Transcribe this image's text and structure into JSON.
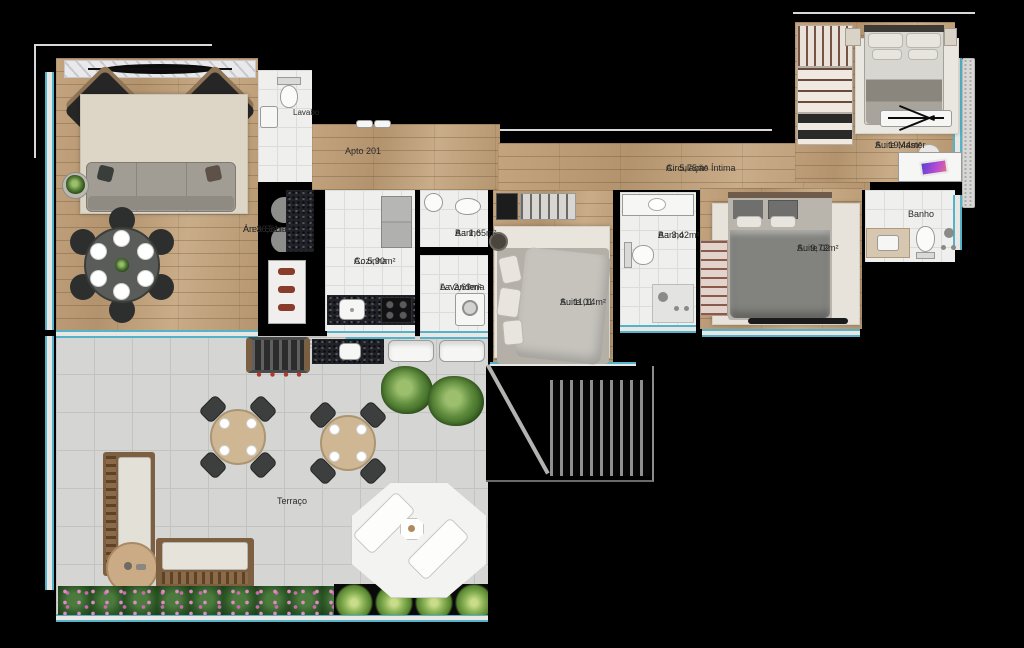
{
  "plan": {
    "unit_label": "Apto 201",
    "rooms": {
      "lavabo": {
        "name": "Lavabo",
        "area": ""
      },
      "area_social": {
        "name": "Área Social",
        "area": "A.: 36,51m²"
      },
      "cozinha": {
        "name": "Cozinha",
        "area": "A.: 5,90m²"
      },
      "banho_social": {
        "name": "Banho",
        "area": "A.: 1,65m²"
      },
      "lavanderia": {
        "name": "Lavanderia",
        "area": "A.: 2,69m²"
      },
      "circulacao": {
        "name": "Circulação Íntima",
        "area": "A.: 5,75m²"
      },
      "suite01": {
        "name": "Suite 01",
        "area": "A.: 11,14m²"
      },
      "banho_intimo": {
        "name": "Banho",
        "area": "A.: 3,42m²"
      },
      "suite02": {
        "name": "Suite 02",
        "area": "A.: 9,72m²"
      },
      "suite_master": {
        "name": "Suite Master",
        "area": "A.: 19,44m²"
      },
      "banho_master": {
        "name": "Banho",
        "area": ""
      },
      "terraco": {
        "name": "Terraço",
        "area": ""
      }
    },
    "colors": {
      "wall": "#000000",
      "window_glass": "#54b3c9",
      "wood_floor": "#bb9c78",
      "tile_floor": "#efefed",
      "terrace_floor": "#d5d5d3"
    }
  }
}
